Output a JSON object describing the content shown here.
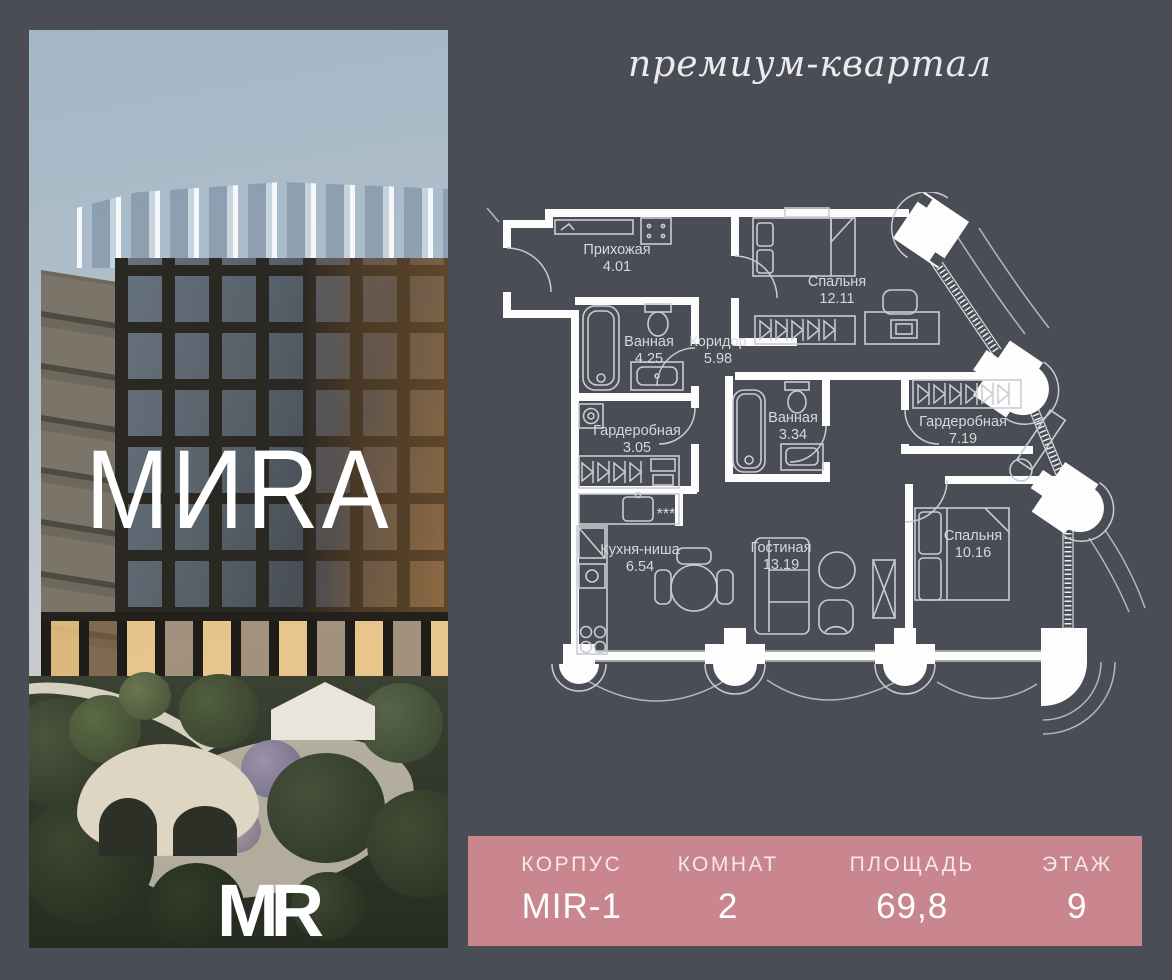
{
  "page": {
    "bg": "#4b4d56"
  },
  "header": {
    "title": "премиум-квартал"
  },
  "photo": {
    "brand_wordmark": "МИRA",
    "logo": "MR"
  },
  "floorplan": {
    "kitchen_burners_symbol": "***",
    "rooms": [
      {
        "name": "Прихожая",
        "area": "4.01"
      },
      {
        "name": "Спальня",
        "area": "12.11"
      },
      {
        "name": "Коридор",
        "area": "5.98"
      },
      {
        "name": "Ванная",
        "area": "4.25"
      },
      {
        "name": "Ванная",
        "area": "3.34"
      },
      {
        "name": "Гардеробная",
        "area": "7.19"
      },
      {
        "name": "Гардеробная",
        "area": "3.05"
      },
      {
        "name": "Кухня-ниша",
        "area": "6.54"
      },
      {
        "name": "Гостиная",
        "area": "13.19"
      },
      {
        "name": "Спальня",
        "area": "10.16"
      }
    ]
  },
  "info_bar": {
    "bg": "#c9868f",
    "columns": [
      {
        "label": "КОРПУС",
        "value": "MIR-1"
      },
      {
        "label": "КОМНАТ",
        "value": "2"
      },
      {
        "label": "ПЛОЩАДЬ",
        "value": "69,8"
      },
      {
        "label": "ЭТАЖ",
        "value": "9"
      }
    ]
  }
}
